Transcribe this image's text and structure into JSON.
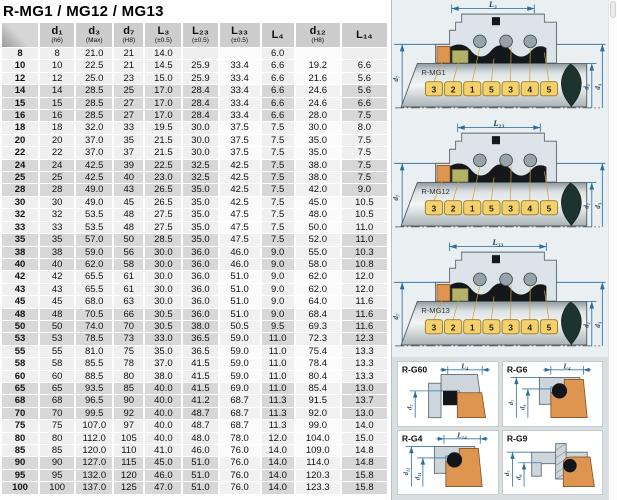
{
  "title": "R-MG1 / MG12 / MG13",
  "table": {
    "columns": [
      {
        "label": "",
        "sub": ""
      },
      {
        "label": "d₁",
        "sub": "(h6)"
      },
      {
        "label": "d₃",
        "sub": "(Max)"
      },
      {
        "label": "d₇",
        "sub": "(H8)"
      },
      {
        "label": "L₃",
        "sub": "(±0.5)"
      },
      {
        "label": "L₂₃",
        "sub": "(±0.5)"
      },
      {
        "label": "L₃₃",
        "sub": "(±0.5)"
      },
      {
        "label": "L₄",
        "sub": ""
      },
      {
        "label": "d₁₂",
        "sub": "(H8)"
      },
      {
        "label": "L₁₄",
        "sub": ""
      }
    ],
    "rows": [
      [
        "8",
        "8",
        "21.0",
        "21",
        "14.0",
        "",
        "",
        "6.0",
        "",
        ""
      ],
      [
        "10",
        "10",
        "22.5",
        "21",
        "14.5",
        "25.9",
        "33.4",
        "6.6",
        "19.2",
        "6.6"
      ],
      [
        "12",
        "12",
        "25.0",
        "23",
        "15.0",
        "25.9",
        "33.4",
        "6.6",
        "21.6",
        "5.6"
      ],
      [
        "14",
        "14",
        "28.5",
        "25",
        "17.0",
        "28.4",
        "33.4",
        "6.6",
        "24.6",
        "5.6"
      ],
      [
        "15",
        "15",
        "28.5",
        "27",
        "17.0",
        "28.4",
        "33.4",
        "6.6",
        "24.6",
        "6.6"
      ],
      [
        "16",
        "16",
        "28.5",
        "27",
        "17.0",
        "28.4",
        "33.4",
        "6.6",
        "28.0",
        "7.5"
      ],
      [
        "18",
        "18",
        "32.0",
        "33",
        "19.5",
        "30.0",
        "37.5",
        "7.5",
        "30.0",
        "8.0"
      ],
      [
        "20",
        "20",
        "37.0",
        "35",
        "21.5",
        "30.0",
        "37.5",
        "7.5",
        "35.0",
        "7.5"
      ],
      [
        "22",
        "22",
        "37.0",
        "37",
        "21.5",
        "30.0",
        "37.5",
        "7.5",
        "35.0",
        "7.5"
      ],
      [
        "24",
        "24",
        "42.5",
        "39",
        "22.5",
        "32.5",
        "42.5",
        "7.5",
        "38.0",
        "7.5"
      ],
      [
        "25",
        "25",
        "42.5",
        "40",
        "23.0",
        "32.5",
        "42.5",
        "7.5",
        "38.0",
        "7.5"
      ],
      [
        "28",
        "28",
        "49.0",
        "43",
        "26.5",
        "35.0",
        "42.5",
        "7.5",
        "42.0",
        "9.0"
      ],
      [
        "30",
        "30",
        "49.0",
        "45",
        "26.5",
        "35.0",
        "42.5",
        "7.5",
        "45.0",
        "10.5"
      ],
      [
        "32",
        "32",
        "53.5",
        "48",
        "27.5",
        "35.0",
        "47.5",
        "7.5",
        "48.0",
        "10.5"
      ],
      [
        "33",
        "33",
        "53.5",
        "48",
        "27.5",
        "35.0",
        "47.5",
        "7.5",
        "50.0",
        "11.0"
      ],
      [
        "35",
        "35",
        "57.0",
        "50",
        "28.5",
        "35.0",
        "47.5",
        "7.5",
        "52.0",
        "11.0"
      ],
      [
        "38",
        "38",
        "59.0",
        "56",
        "30.0",
        "36.0",
        "46.0",
        "9.0",
        "55.0",
        "10.3"
      ],
      [
        "40",
        "40",
        "62.0",
        "58",
        "30.0",
        "36.0",
        "46.0",
        "9.0",
        "58.0",
        "10.8"
      ],
      [
        "42",
        "42",
        "65.5",
        "61",
        "30.0",
        "36.0",
        "51.0",
        "9.0",
        "62.0",
        "12.0"
      ],
      [
        "43",
        "43",
        "65.5",
        "61",
        "30.0",
        "36.0",
        "51.0",
        "9.0",
        "62.0",
        "12.0"
      ],
      [
        "45",
        "45",
        "68.0",
        "63",
        "30.0",
        "36.0",
        "51.0",
        "9.0",
        "64.0",
        "11.6"
      ],
      [
        "48",
        "48",
        "70.5",
        "66",
        "30.5",
        "36.0",
        "51.0",
        "9.0",
        "68.4",
        "11.6"
      ],
      [
        "50",
        "50",
        "74.0",
        "70",
        "30.5",
        "38.0",
        "50.5",
        "9.5",
        "69.3",
        "11.6"
      ],
      [
        "53",
        "53",
        "78.5",
        "73",
        "33.0",
        "36.5",
        "59.0",
        "11.0",
        "72.3",
        "12.3"
      ],
      [
        "55",
        "55",
        "81.0",
        "75",
        "35.0",
        "36.5",
        "59.0",
        "11.0",
        "75.4",
        "13.3"
      ],
      [
        "58",
        "58",
        "85.5",
        "78",
        "37.0",
        "41.5",
        "59.0",
        "11.0",
        "78.4",
        "13.3"
      ],
      [
        "60",
        "60",
        "88.5",
        "80",
        "38.0",
        "41.5",
        "59.0",
        "11.0",
        "80.4",
        "13.3"
      ],
      [
        "65",
        "65",
        "93.5",
        "85",
        "40.0",
        "41.5",
        "69.0",
        "11.0",
        "85.4",
        "13.0"
      ],
      [
        "68",
        "68",
        "96.5",
        "90",
        "40.0",
        "41.2",
        "68.7",
        "11.3",
        "91.5",
        "13.7"
      ],
      [
        "70",
        "70",
        "99.5",
        "92",
        "40.0",
        "48.7",
        "68.7",
        "11.3",
        "92.0",
        "13.0"
      ],
      [
        "75",
        "75",
        "107.0",
        "97",
        "40.0",
        "48.7",
        "68.7",
        "11.3",
        "99.0",
        "14.0"
      ],
      [
        "80",
        "80",
        "112.0",
        "105",
        "40.0",
        "48.0",
        "78.0",
        "12.0",
        "104.0",
        "15.0"
      ],
      [
        "85",
        "85",
        "120.0",
        "110",
        "41.0",
        "46.0",
        "76.0",
        "14.0",
        "109.0",
        "14.8"
      ],
      [
        "90",
        "90",
        "127.0",
        "115",
        "45.0",
        "51.0",
        "76.0",
        "14.0",
        "114.0",
        "14.8"
      ],
      [
        "95",
        "95",
        "132.0",
        "120",
        "46.0",
        "51.0",
        "76.0",
        "14.0",
        "120.3",
        "15.8"
      ],
      [
        "100",
        "100",
        "137.0",
        "125",
        "47.0",
        "51.0",
        "76.0",
        "14.0",
        "123.3",
        "15.8"
      ]
    ]
  },
  "diagrams": {
    "main": [
      {
        "name": "R-MG1",
        "dim_label": "L₃",
        "left_dim": "d₇",
        "right_dims": [
          "d₁",
          "d₃"
        ],
        "numbers": [
          "3",
          "2",
          "1",
          "5",
          "3",
          "4",
          "5"
        ]
      },
      {
        "name": "R-MG12",
        "dim_label": "L₂₃",
        "left_dim": "d₇",
        "right_dims": [
          "d₁",
          "d₃"
        ],
        "numbers": [
          "3",
          "2",
          "1",
          "5",
          "3",
          "4",
          "5"
        ]
      },
      {
        "name": "R-MG13",
        "dim_label": "L₃₃",
        "left_dim": "d₇",
        "right_dims": [
          "d₁",
          "d₃"
        ],
        "numbers": [
          "3",
          "2",
          "1",
          "5",
          "3",
          "4",
          "5"
        ]
      }
    ],
    "small": [
      {
        "name": "R-G60",
        "top_dim": "L₄",
        "left_dims": [
          "d₇"
        ]
      },
      {
        "name": "R-G6",
        "top_dim": "L₄",
        "left_dims": [
          "d₇",
          "d₆"
        ]
      },
      {
        "name": "R-G4",
        "top_dim": "L₁₄",
        "left_dims": [
          "d₁₂",
          "d₁₁"
        ]
      },
      {
        "name": "R-G9",
        "top_dim": "",
        "left_dims": [
          "d₇",
          "d₆"
        ]
      }
    ]
  },
  "colors": {
    "accent_dim": "#2e6d99",
    "seat_orange": "#dd9550",
    "carbon_olive": "#b2b26a",
    "metal_grey": "#ccd6dc",
    "number_box": "#f3d26e",
    "row_grey": "#d7d7d7"
  }
}
